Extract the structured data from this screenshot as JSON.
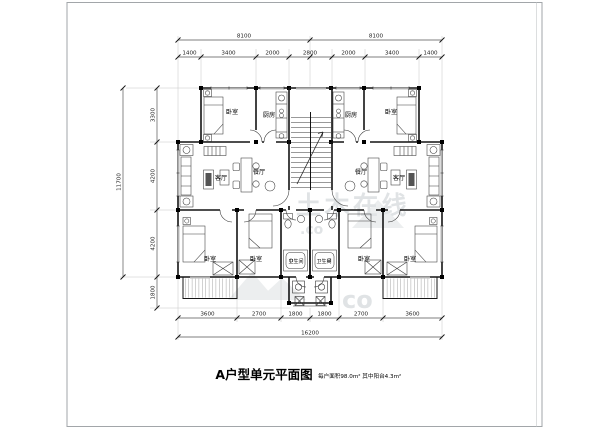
{
  "title": {
    "main": "A户型单元平面图",
    "subtitle": "每户面积98.0m² 其中阳台4.3m²"
  },
  "watermark": {
    "text": "土木在线",
    "suffix": ".co",
    "big": "co"
  },
  "dims": {
    "top_totals": [
      "8100",
      "8100"
    ],
    "top_subs": [
      "1400",
      "3400",
      "2000",
      "2800",
      "2000",
      "3400",
      "1400"
    ],
    "left_total": "11700",
    "left_subs": [
      "3300",
      "4200",
      "4200",
      "1800"
    ],
    "bottom_subs": [
      "3600",
      "2700",
      "1800",
      "1800",
      "2700",
      "3600"
    ],
    "bottom_total": "16200"
  },
  "rooms": {
    "bedroom": "卧室",
    "kitchen": "厨房",
    "living": "客厅",
    "dining": "餐厅",
    "bathroom": "卫生间"
  }
}
